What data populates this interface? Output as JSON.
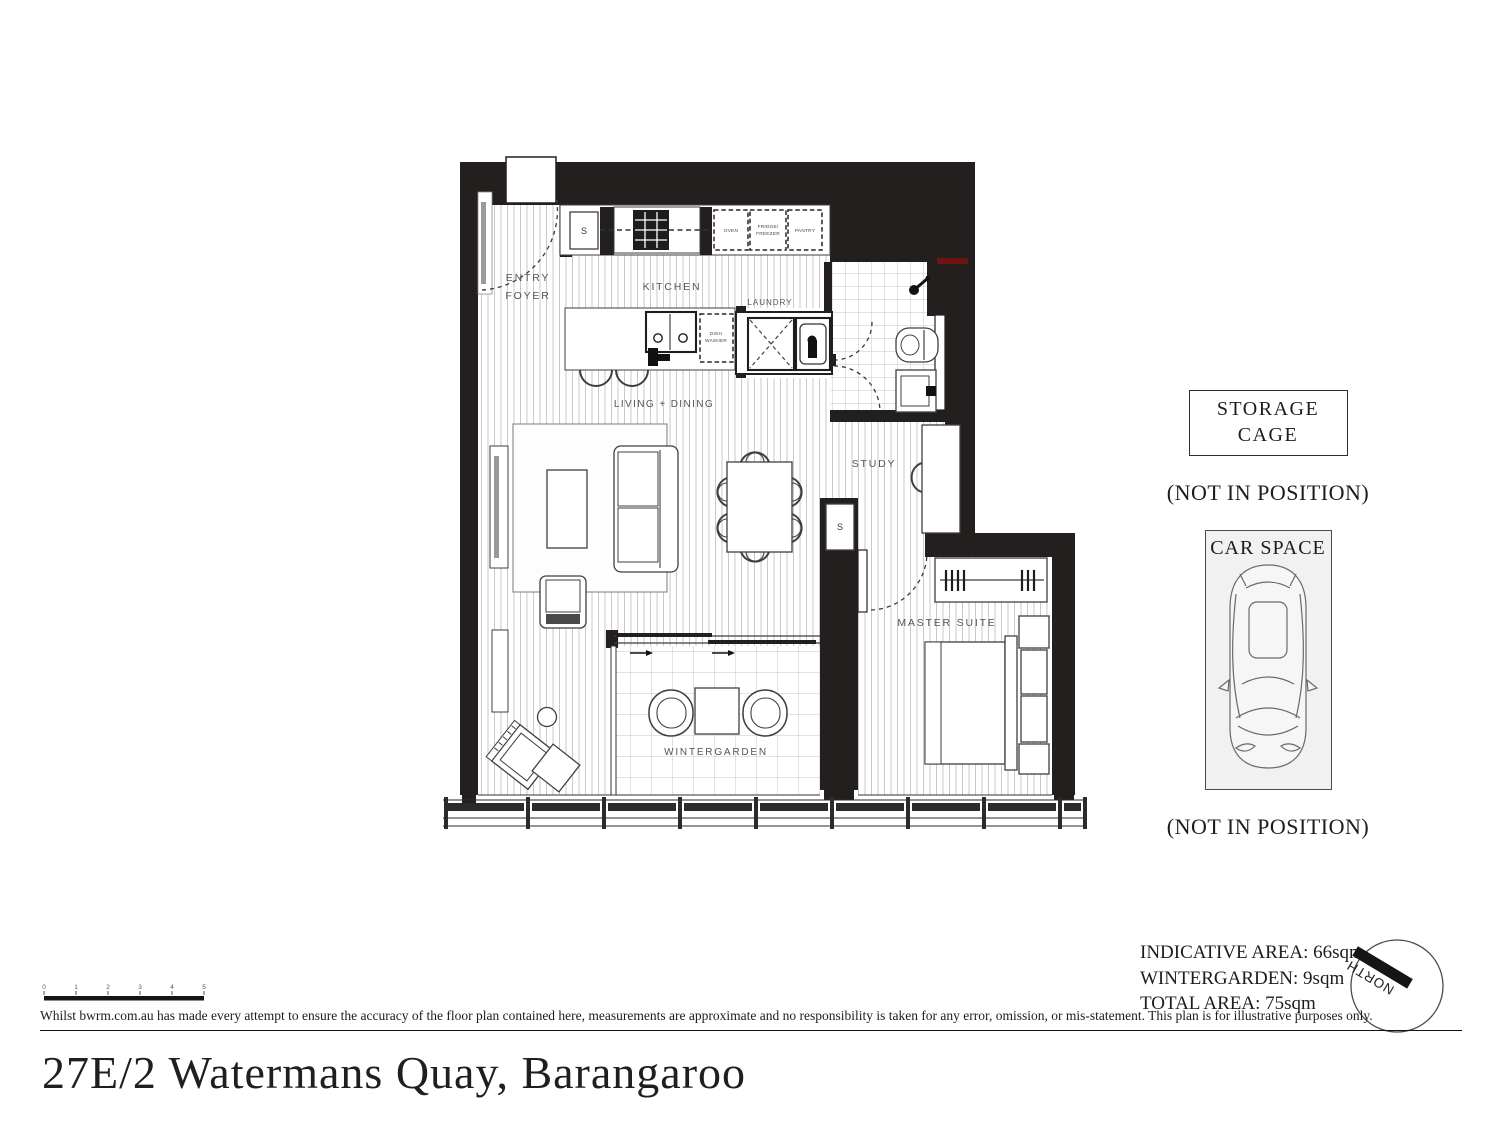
{
  "plan": {
    "rooms": {
      "entry_line1": "ENTRY",
      "entry_line2": "FOYER",
      "kitchen": "KITCHEN",
      "laundry": "LAUNDRY",
      "living_dining": "LIVING + DINING",
      "study": "STUDY",
      "master_suite": "MASTER SUITE",
      "wintergarden": "WINTERGARDEN"
    },
    "markers": {
      "storage": "S",
      "oven": "OVEN",
      "fridge_line1": "FRIDGE/",
      "fridge_line2": "FREEZER",
      "pantry": "PANTRY",
      "dishwasher_line1": "DISH",
      "dishwasher_line2": "WASHER"
    }
  },
  "annotations": {
    "storage_cage_line1": "STORAGE",
    "storage_cage_line2": "CAGE",
    "storage_not_in_position": "(NOT IN POSITION)",
    "car_space": "CAR SPACE",
    "car_not_in_position": "(NOT IN POSITION)"
  },
  "areas": {
    "indicative": "INDICATIVE AREA: 66sqm",
    "wintergarden": "WINTERGARDEN: 9sqm",
    "total": "TOTAL AREA: 75sqm"
  },
  "compass": {
    "north": "NORTH"
  },
  "scale_bar": {
    "ticks": [
      "0",
      "1",
      "2",
      "3",
      "4",
      "5"
    ]
  },
  "footer": {
    "disclaimer": "Whilst bwrm.com.au has made every attempt to ensure the accuracy of the floor plan contained here, measurements are approximate and no responsibility is taken for any error, omission, or mis-statement. This plan is for illustrative purposes only.",
    "address": "27E/2 Watermans Quay, Barangaroo"
  },
  "colors": {
    "wall": "#241f1f",
    "floor_line": "#c9c9c9",
    "tile_line": "#c4c4c4",
    "accent_red": "#6e1512",
    "text_dark": "#1c1c1c",
    "label_gray": "#555555",
    "car_space_bg": "#f1f1f1"
  }
}
